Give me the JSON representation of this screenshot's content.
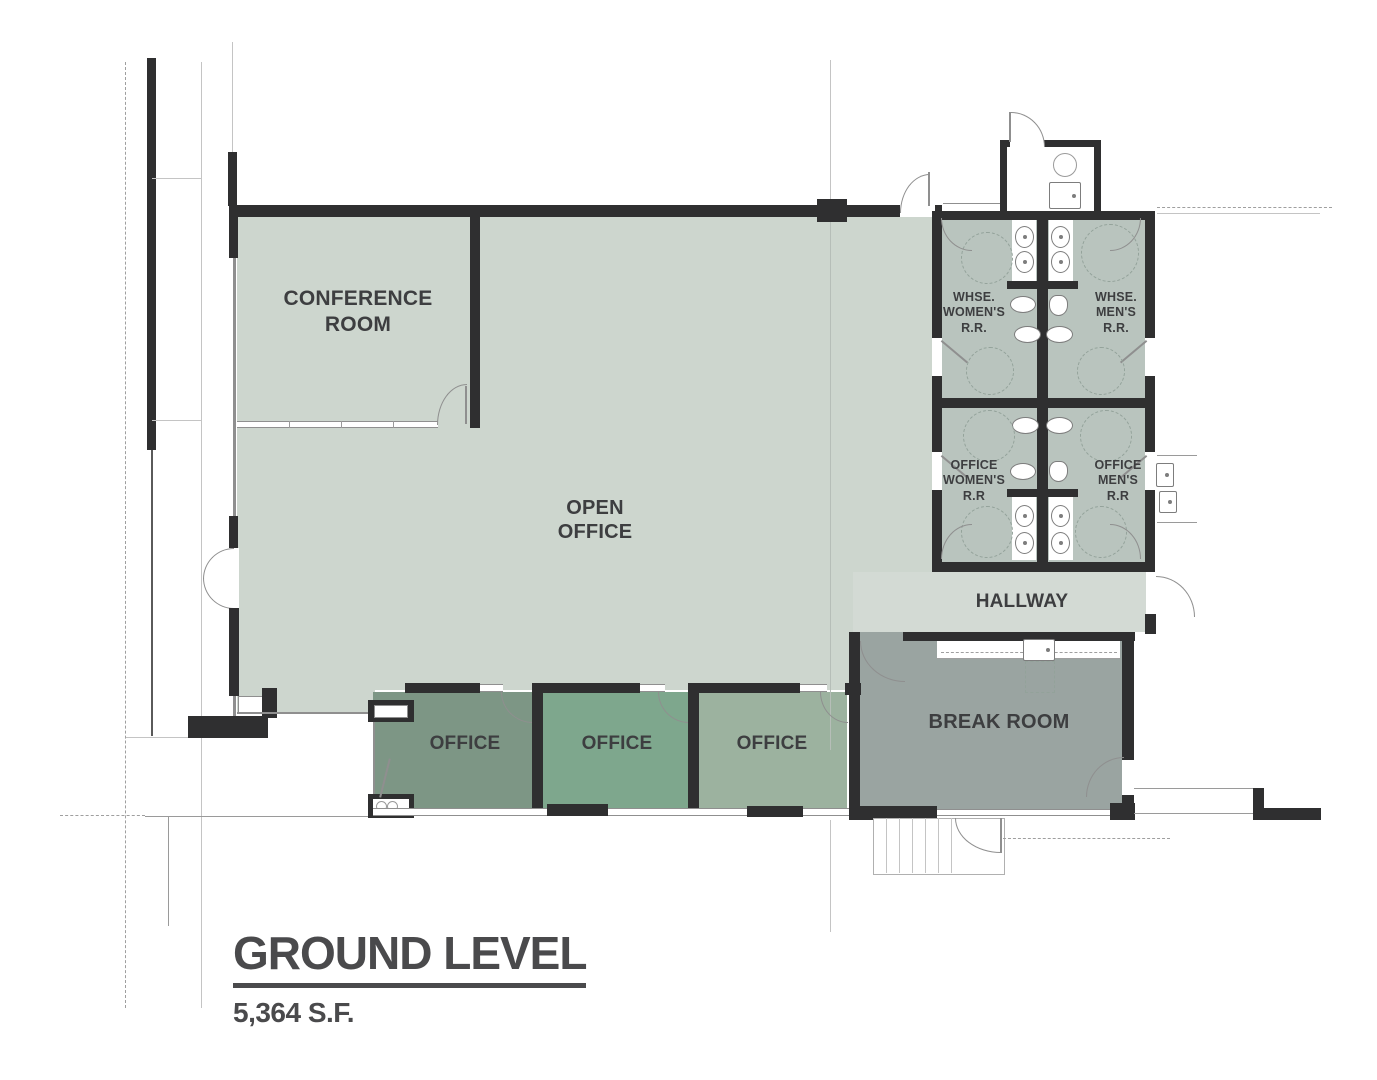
{
  "title": {
    "heading": "GROUND LEVEL",
    "area": "5,364 S.F."
  },
  "rooms": {
    "conference": {
      "label": "CONFERENCE\nROOM"
    },
    "open_office": {
      "label": "OPEN\nOFFICE"
    },
    "whse_womens_rr": {
      "label": "WHSE.\nWOMEN'S\nR.R."
    },
    "whse_mens_rr": {
      "label": "WHSE.\nMEN'S\nR.R."
    },
    "office_womens_rr": {
      "label": "OFFICE\nWOMEN'S\nR.R"
    },
    "office_mens_rr": {
      "label": "OFFICE\nMEN'S\nR.R"
    },
    "hallway": {
      "label": "HALLWAY"
    },
    "break_room": {
      "label": "BREAK ROOM"
    },
    "office_1": {
      "label": "OFFICE"
    },
    "office_2": {
      "label": "OFFICE"
    },
    "office_3": {
      "label": "OFFICE"
    }
  },
  "colors": {
    "canvas-bg": "#ffffff",
    "wall": "#2f2f30",
    "room-sage": "#cdd6ce",
    "hallway-fill": "#d3dad4",
    "restroom-fill": "#b9c4be",
    "break-room-fill": "#9aa4a1",
    "office-1-fill": "#7d9685",
    "office-2-fill": "#7ea78d",
    "office-3-fill": "#9cb29f",
    "label-color": "#3d3e40",
    "title-color": "#4a4a4c",
    "clearance-dash": "#93a29a",
    "fixture-outline": "#7d7d7d"
  }
}
